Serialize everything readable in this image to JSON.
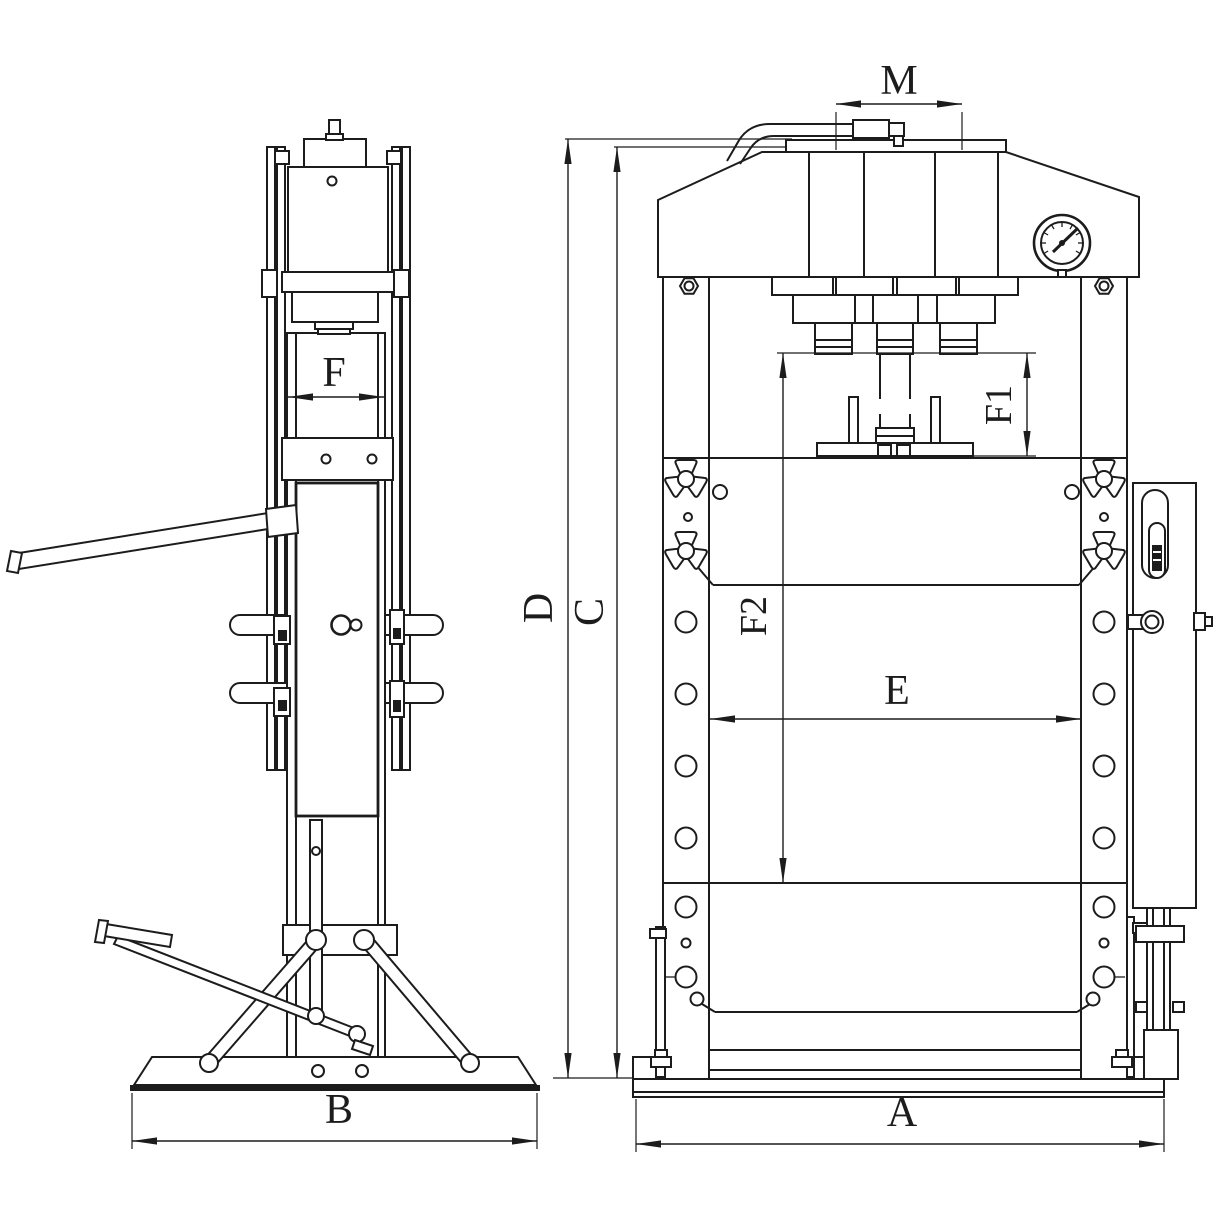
{
  "colors": {
    "background": "#ffffff",
    "line": "#1c1c1c"
  },
  "dimension_labels": {
    "a": "A",
    "b": "B",
    "c": "C",
    "d": "D",
    "e": "E",
    "f": "F",
    "f1": "F1",
    "f2": "F2",
    "m": "M"
  }
}
